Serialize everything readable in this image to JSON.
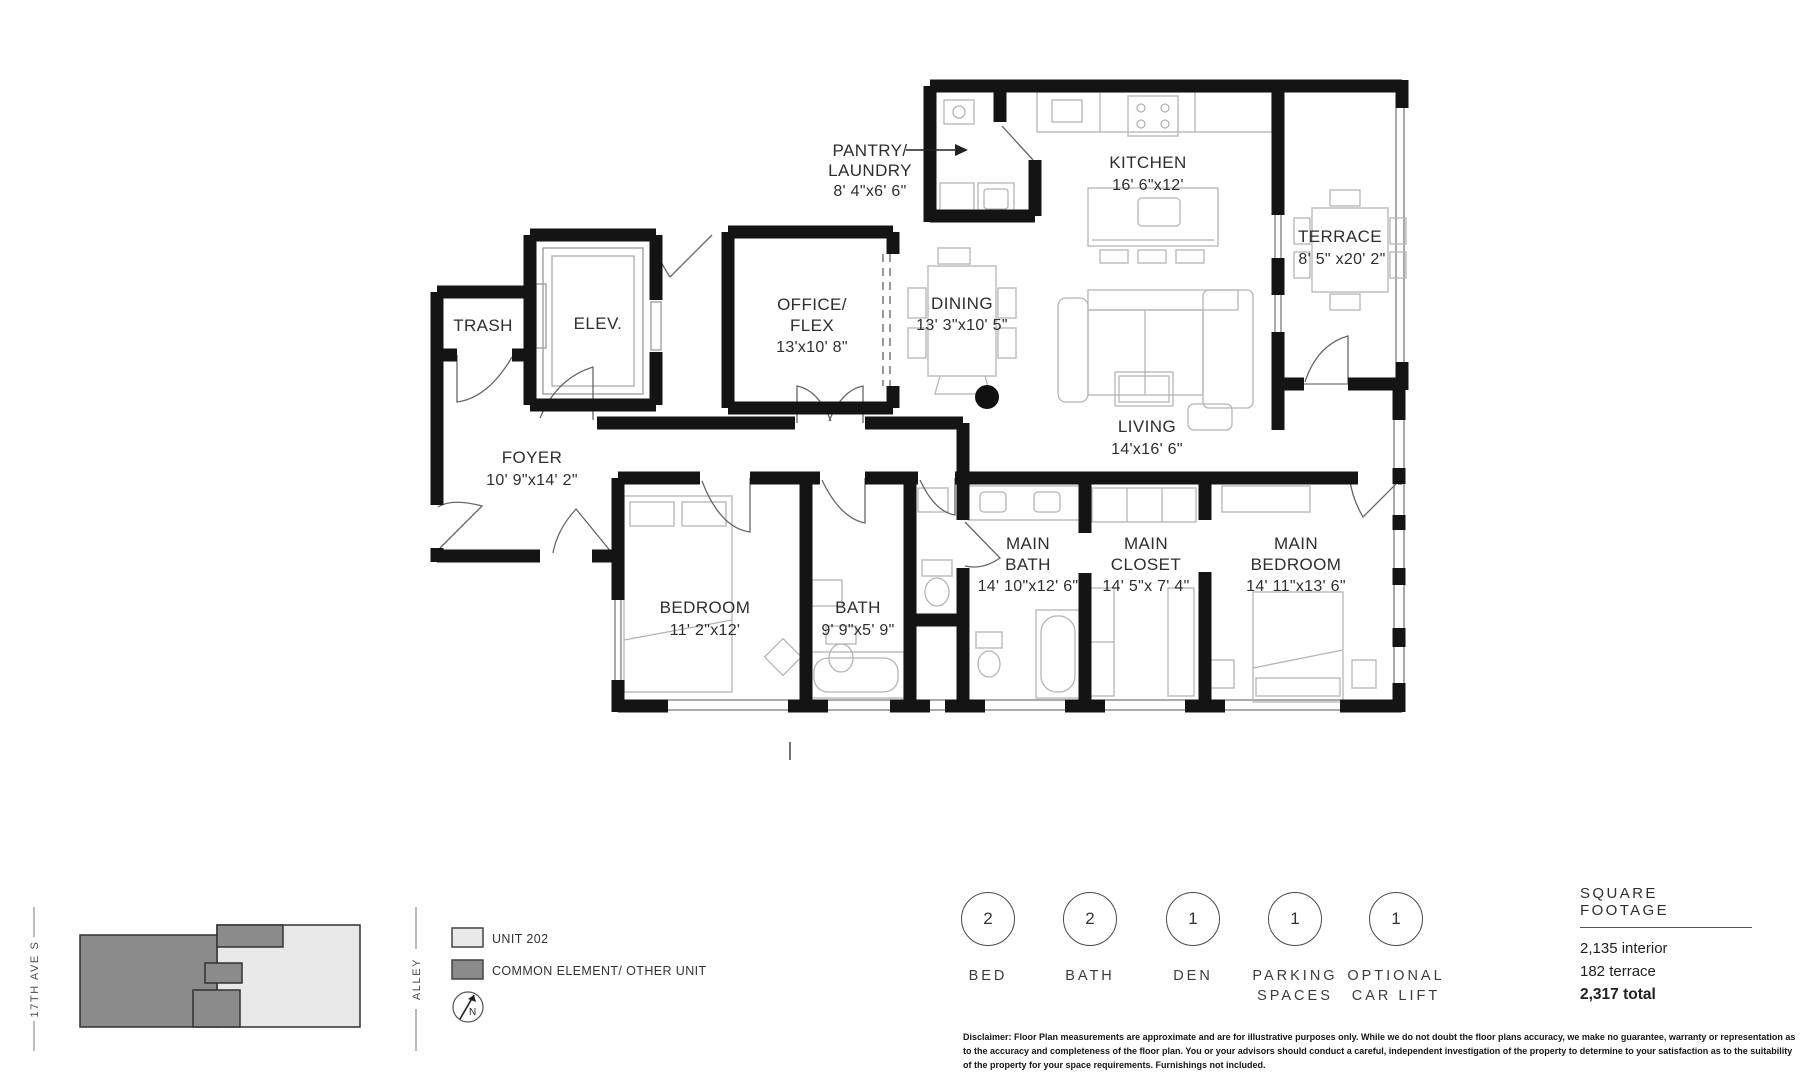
{
  "floor_plan": {
    "rooms": {
      "pantry_laundry": {
        "lines": [
          "PANTRY/",
          "LAUNDRY",
          "8' 4\"x6' 6\""
        ]
      },
      "kitchen": {
        "lines": [
          "KITCHEN",
          "16' 6\"x12'"
        ]
      },
      "terrace": {
        "lines": [
          "TERRACE",
          "8' 5\" x20' 2\""
        ]
      },
      "office_flex": {
        "lines": [
          "OFFICE/",
          "FLEX",
          "13'x10' 8\""
        ]
      },
      "dining": {
        "lines": [
          "DINING",
          "13' 3\"x10' 5\""
        ]
      },
      "living": {
        "lines": [
          "LIVING",
          "14'x16' 6\""
        ]
      },
      "trash": {
        "lines": [
          "TRASH"
        ]
      },
      "elevator": {
        "lines": [
          "ELEV."
        ]
      },
      "foyer": {
        "lines": [
          "FOYER",
          "10' 9\"x14' 2\""
        ]
      },
      "bedroom": {
        "lines": [
          "BEDROOM",
          "11' 2\"x12'"
        ]
      },
      "bath": {
        "lines": [
          "BATH",
          "9' 9\"x5' 9\""
        ]
      },
      "main_bath": {
        "lines": [
          "MAIN",
          "BATH",
          "14' 10\"x12' 6\""
        ]
      },
      "main_closet": {
        "lines": [
          "MAIN",
          "CLOSET",
          "14' 5\"x 7' 4\""
        ]
      },
      "main_bedroom": {
        "lines": [
          "MAIN",
          "BEDROOM",
          "14' 11\"x13' 6\""
        ]
      }
    }
  },
  "key_plan": {
    "street_left": "17TH AVE S",
    "street_right": "ALLEY",
    "north_label": "N"
  },
  "legend": {
    "unit_label": "UNIT 202",
    "common_label": "COMMON ELEMENT/ OTHER UNIT",
    "unit_color": "#e9e9e9",
    "common_color": "#8b8b8b"
  },
  "stats": [
    {
      "value": "2",
      "lines": [
        "BED"
      ]
    },
    {
      "value": "2",
      "lines": [
        "BATH"
      ]
    },
    {
      "value": "1",
      "lines": [
        "DEN"
      ]
    },
    {
      "value": "1",
      "lines": [
        "PARKING",
        "SPACES"
      ]
    },
    {
      "value": "1",
      "lines": [
        "OPTIONAL",
        "CAR LIFT"
      ]
    }
  ],
  "square_footage": {
    "title": "SQUARE FOOTAGE",
    "interior": "2,135 interior",
    "terrace": "182 terrace",
    "total": "2,317 total"
  },
  "disclaimer": "Disclaimer: Floor Plan measurements are approximate and are for illustrative purposes only. While we do not doubt the floor plans accuracy, we make no guarantee, warranty or representation as to the accuracy and completeness of the floor plan. You or your advisors should conduct a careful, independent investigation of the property to determine to your satisfaction as to the suitability of the property for your space requirements. Furnishings not included."
}
